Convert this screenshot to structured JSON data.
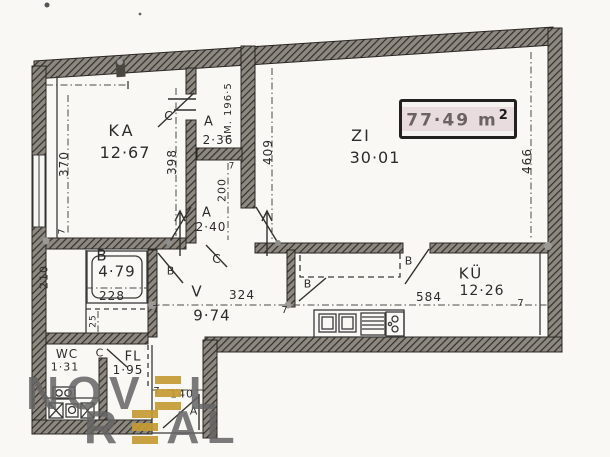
{
  "area_box": {
    "value": "77·49",
    "unit": "m",
    "sup": "2"
  },
  "rooms": {
    "ka": {
      "name": "KA",
      "area": "12·67"
    },
    "zi": {
      "name": "ZI",
      "area": "30·01"
    },
    "a1": {
      "name": "A",
      "area": "2·36"
    },
    "a2": {
      "name": "A",
      "area": "2·40"
    },
    "b": {
      "name": "B",
      "area": "4·79"
    },
    "v": {
      "name": "V",
      "area": "9·74"
    },
    "ku": {
      "name": "KÜ",
      "area": "12·26"
    },
    "wc": {
      "name": "WC",
      "area": "1·31"
    },
    "fl": {
      "name": "FL",
      "area": "1·95"
    }
  },
  "dimensions": {
    "d370": "370",
    "d398": "398",
    "d409": "409",
    "d466": "466",
    "d200": "200",
    "d210": "210",
    "d228": "228",
    "d25": "25",
    "d324": "324",
    "d584": "584",
    "d140": "140",
    "height_note": "iM. 196·5",
    "t1": "7",
    "t2": "7",
    "t3": "7",
    "t4": "7",
    "t5": "7",
    "t6": "7"
  },
  "door_labels": {
    "c1": "C",
    "c2": "C",
    "c3": "C",
    "b1": "B",
    "b2": "B",
    "b3": "B",
    "a_entry": "A"
  },
  "watermark": {
    "line1_pre": "NOV",
    "line1_post": "L",
    "line2_pre": "R",
    "line2_post": "AL",
    "gold": "#c49a33"
  },
  "colors": {
    "ink": "#2e2c2a",
    "wall_fill": "#8d8880",
    "highlight": "#e9dcdf"
  }
}
